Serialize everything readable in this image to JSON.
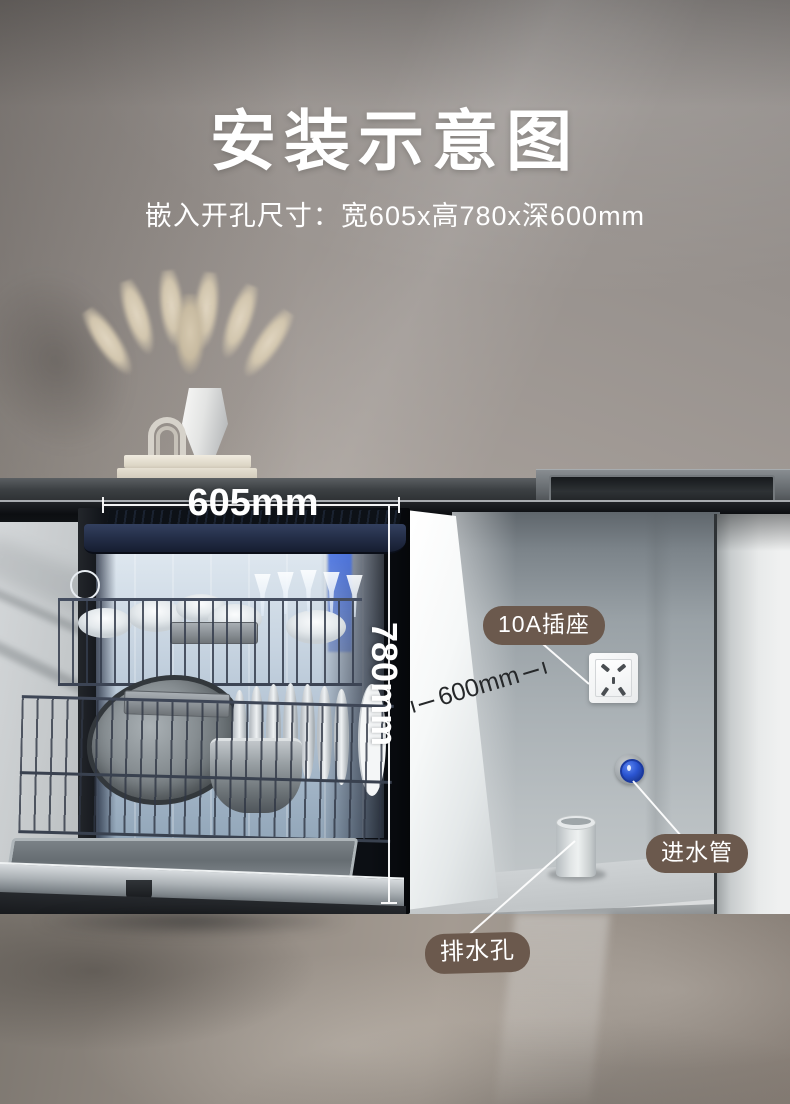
{
  "header": {
    "title": "安装示意图",
    "subtitle": "嵌入开孔尺寸：宽605x高780x深600mm"
  },
  "dimensions": {
    "width": "605mm",
    "height": "780mm",
    "depth": "600mm"
  },
  "callouts": {
    "socket": "10A插座",
    "inlet": "进水管",
    "drain": "排水孔"
  },
  "colors": {
    "callout_bg": "#6b594d",
    "callout_text": "#ffffff",
    "dimension_light": "#ffffff",
    "dimension_dark": "#26282a",
    "inlet_valve_blue": "#2b55d2",
    "dishwasher_lid_navy": "#222c45"
  }
}
